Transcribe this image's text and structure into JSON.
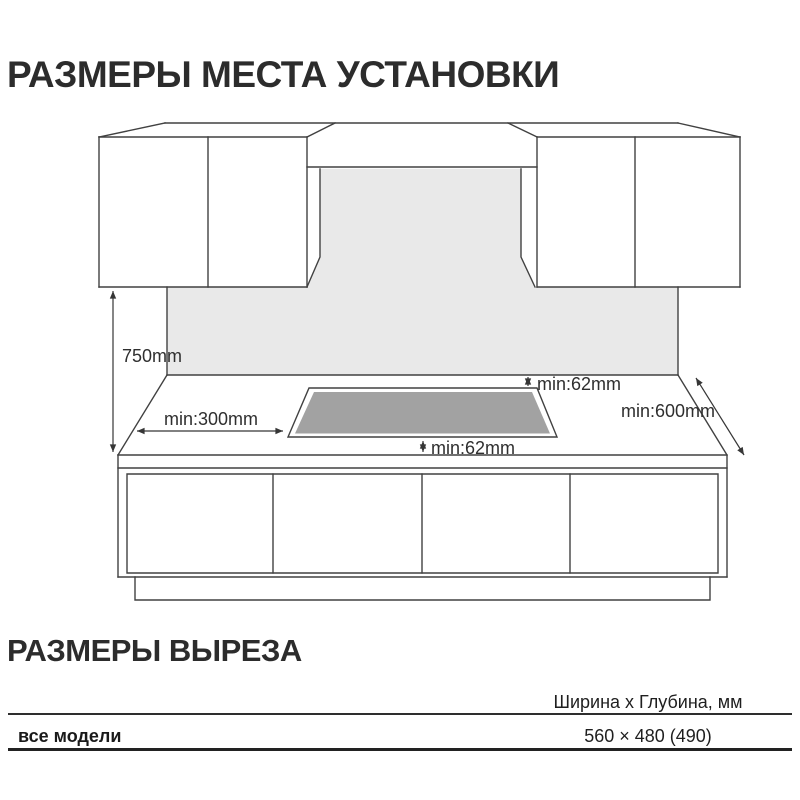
{
  "titles": {
    "installation": "РАЗМЕРЫ МЕСТА УСТАНОВКИ",
    "cutout": "РАЗМЕРЫ ВЫРЕЗА"
  },
  "diagram": {
    "labels": {
      "worktop_height": "750mm",
      "side_clearance": "min:300mm",
      "back_clearance": "min:62mm",
      "front_clearance": "min:62mm",
      "worktop_depth": "min:600mm"
    },
    "colors": {
      "backsplash": "#e9e9e9",
      "cooktop": "#a2a2a2",
      "line": "#414141"
    }
  },
  "cutout_table": {
    "size_header": "Ширина x Глубина, мм",
    "rows": [
      {
        "model": "все модели",
        "size": "560 × 480 (490)"
      }
    ]
  }
}
